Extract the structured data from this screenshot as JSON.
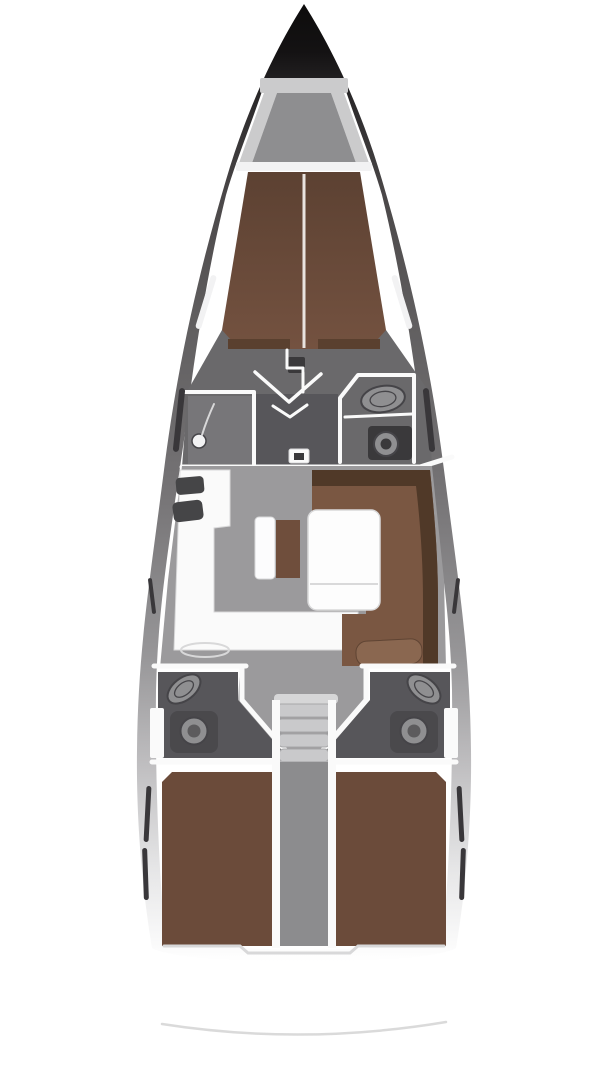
{
  "diagram": {
    "type": "yacht-interior-floor-plan",
    "view": "top-down",
    "orientation": "bow-up",
    "rooms": [
      {
        "id": "anchor-locker",
        "label": "anchor locker"
      },
      {
        "id": "fore-cabin",
        "label": "forward cabin with v-berth"
      },
      {
        "id": "fore-head",
        "label": "forward head with sink and toilet"
      },
      {
        "id": "shower",
        "label": "forward shower compartment"
      },
      {
        "id": "salon",
        "label": "salon with settee and table"
      },
      {
        "id": "galley",
        "label": "l-shaped galley with twin sinks"
      },
      {
        "id": "companionway",
        "label": "companionway steps"
      },
      {
        "id": "aft-head-port",
        "label": "aft head port"
      },
      {
        "id": "aft-head-starboard",
        "label": "aft head starboard"
      },
      {
        "id": "aft-cabin-port",
        "label": "aft cabin port with double berth"
      },
      {
        "id": "aft-cabin-starboard",
        "label": "aft cabin starboard with double berth"
      }
    ]
  },
  "colors": {
    "page_bg": "#ffffff",
    "deck_white": "#ffffff",
    "hull_gradient": [
      "#0d0c0c",
      "#141213",
      "#2b292a",
      "#4a4748",
      "#605e5f",
      "#747274",
      "#979698",
      "#c1c0c2",
      "#e5e5e6",
      "#ffffff"
    ],
    "berth_gradient": [
      "#5c4132",
      "#745240"
    ],
    "locker_wall": "#cbcbcc",
    "locker_floor": "#8e8e90",
    "wall_white": "#fafafa",
    "wall_light": "#d8d8d9",
    "berth_brown": "#6f4e3c",
    "berth_brown_dark": "#5a402f",
    "berth_split": "#e9e3df",
    "upholstery": "#7a5742",
    "upholstery_dark": "#503928",
    "upholstery_light": "#8a6750",
    "bolster_edge": "#5f4433",
    "bed_brown": "#6b4b3a",
    "floor_gray": "#9b9a9c",
    "floor_dark": "#57565a",
    "head_floor": "#6a696b",
    "shower_floor": "#777679",
    "fixture_light": "#8f8f91",
    "fixture_rim": "#454448",
    "toilet_zone": "#4a494c",
    "appliance_dark": "#3a393b",
    "sink_dark": "#454547",
    "steps_light": "#c9c9cb",
    "steps_edge": "#a8a8aa",
    "steps_top": "#d6d6d7",
    "steps_base": "#b4b4b6",
    "engine_gray": "#8c8c8e",
    "table_white": "#fdfdfd",
    "table_line": "#d9d9da",
    "bench_white": "#fcfcfd",
    "window_dark": "#39373a",
    "window_light": "#f2f2f3",
    "transom_line": "#d3d3d4"
  }
}
